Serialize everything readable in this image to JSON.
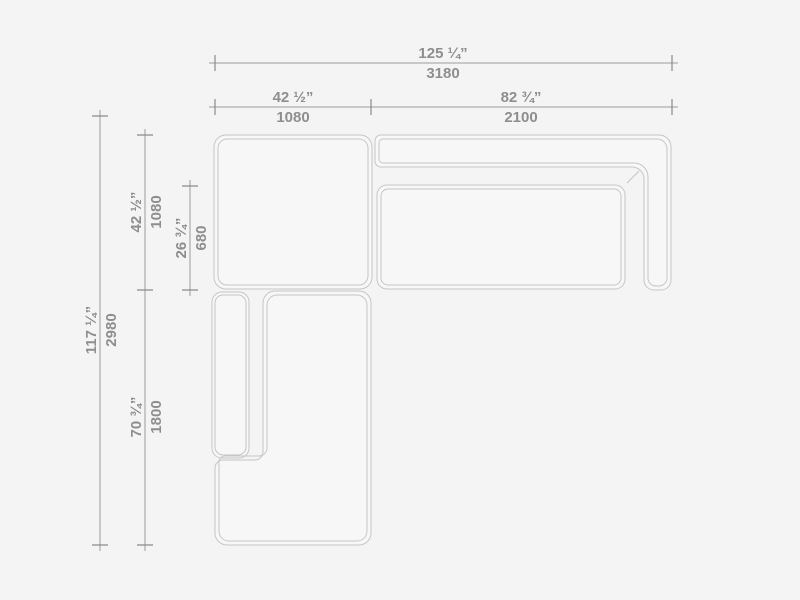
{
  "colors": {
    "bg": "#f4f4f4",
    "fill": "#f7f7f7",
    "outline": "#c6c6c6",
    "dimline": "#9b9b9b",
    "tick": "#8a8a8a",
    "dimtext": "#8e8e8e"
  },
  "dims": {
    "overall_width": {
      "in": "125 ¼”",
      "mm": "3180"
    },
    "left_module_width": {
      "in": "42 ½”",
      "mm": "1080"
    },
    "right_module_width": {
      "in": "82 ¾”",
      "mm": "2100"
    },
    "overall_depth": {
      "in": "117 ¼”",
      "mm": "2980"
    },
    "top_module_depth": {
      "in": "42 ½”",
      "mm": "1080"
    },
    "seat_depth": {
      "in": "26 ¾”",
      "mm": "680"
    },
    "bottom_module_length": {
      "in": "70 ¾”",
      "mm": "1800"
    }
  }
}
